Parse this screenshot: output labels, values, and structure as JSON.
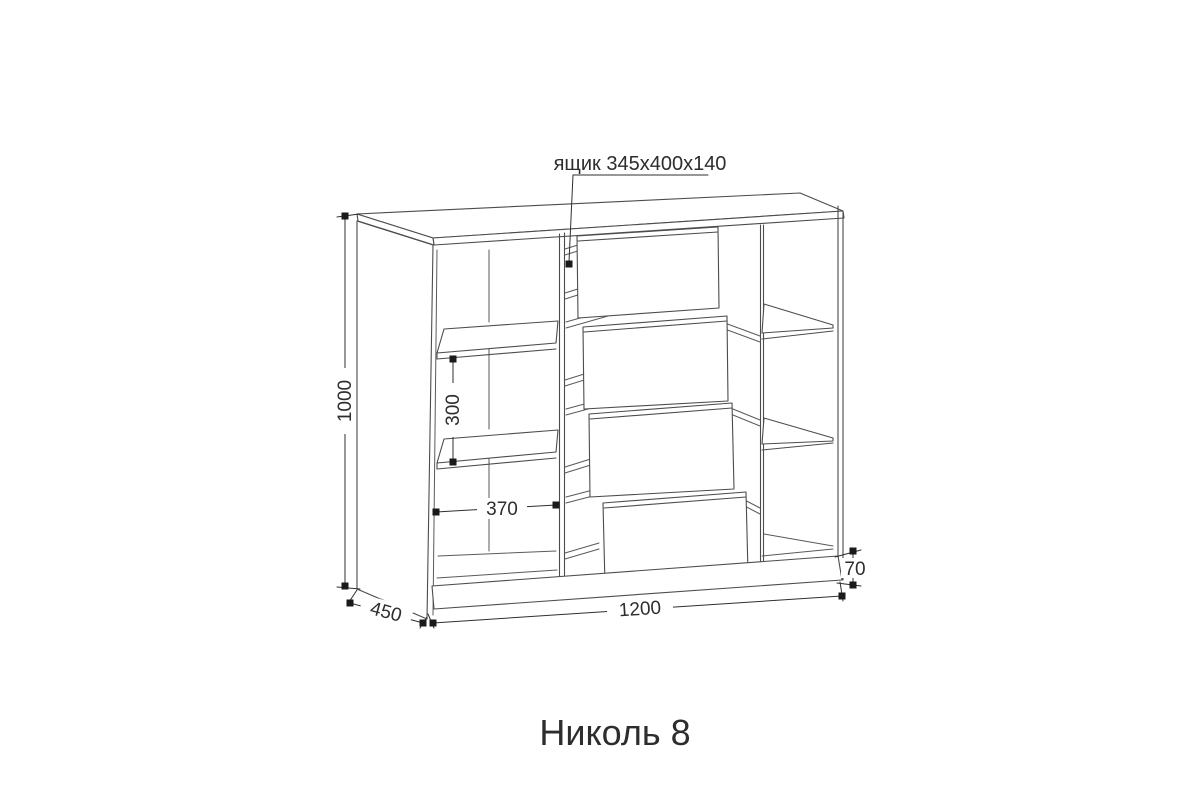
{
  "drawing": {
    "title": "Николь 8",
    "drawer_callout": "ящик 345х400х140",
    "dimensions": {
      "overall_height": "1000",
      "shelf_gap": "300",
      "compartment_width": "370",
      "depth": "450",
      "overall_width": "1200",
      "plinth_height": "70"
    }
  },
  "colors": {
    "line": "#4c4c4c",
    "dimension": "#2f2f2f",
    "marker": "#1a1a1a",
    "background": "#ffffff"
  }
}
